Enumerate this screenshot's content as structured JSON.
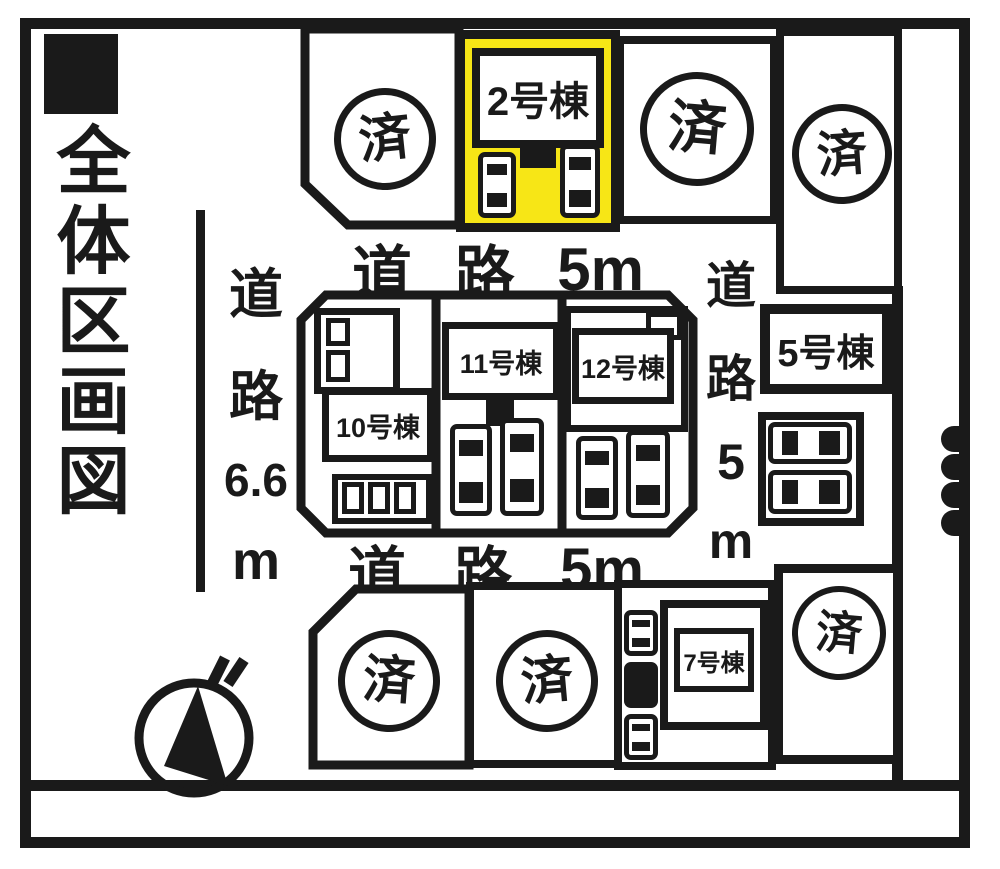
{
  "title": {
    "marker": "■",
    "text": "全体区画図"
  },
  "roads": {
    "top": {
      "parts": [
        "道",
        "路",
        "5m"
      ]
    },
    "bottom": {
      "parts": [
        "道",
        "路",
        "5m"
      ]
    },
    "left": {
      "parts": [
        "道",
        "路",
        "6.6",
        "m"
      ]
    },
    "right": {
      "parts": [
        "道",
        "路",
        "5",
        "m"
      ]
    }
  },
  "stamp": {
    "sold": "済"
  },
  "buildings": {
    "b2": "2号棟",
    "b5": "5号棟",
    "b7": "7号棟",
    "b10": "10号棟",
    "b11": "11号棟",
    "b12": "12号棟"
  },
  "colors": {
    "ink": "#1a1a1a",
    "paper": "#ffffff",
    "highlight": "#f7e616"
  }
}
